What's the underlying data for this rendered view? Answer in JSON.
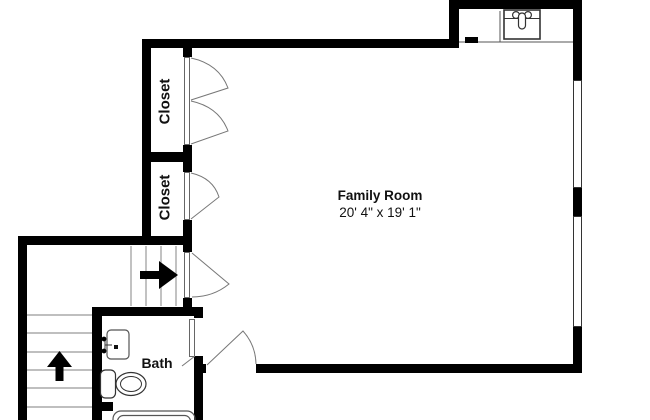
{
  "title": "Floor plan",
  "rooms": {
    "family_room": {
      "label": "Family Room",
      "dimensions": "20' 4\" x 19' 1\""
    },
    "closet_top": {
      "label": "Closet"
    },
    "closet_bottom": {
      "label": "Closet"
    },
    "bath": {
      "label": "Bath"
    }
  },
  "fixtures": {
    "wet_bar_sink": "sink-icon",
    "vanity_sink": "vanity-sink-icon",
    "toilet": "toilet-icon",
    "bathtub": "bathtub-icon",
    "stairs_lower_direction": "arrow-up-icon",
    "stairs_upper_direction": "arrow-right-icon",
    "window_count": 2,
    "door_count": 5
  },
  "colors": {
    "wall": "#000000",
    "background": "#ffffff",
    "fixture_stroke": "#333333",
    "door_swing_stroke": "#777777",
    "stair_tread": "#999999",
    "counter_line": "#555555",
    "text": "#111111"
  }
}
